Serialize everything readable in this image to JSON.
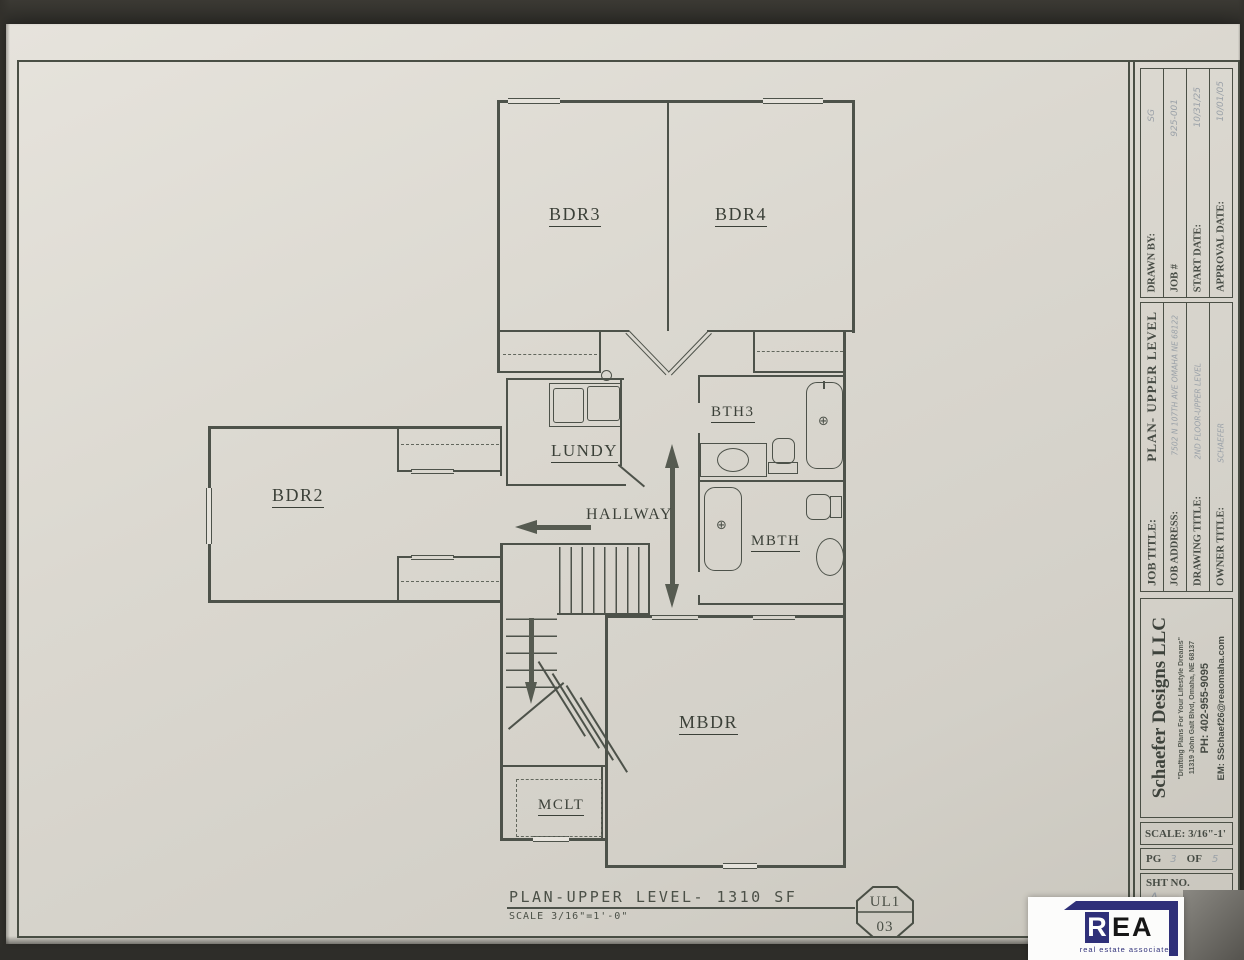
{
  "plan": {
    "rooms": {
      "bdr2": "BDR2",
      "bdr3": "BDR3",
      "bdr4": "BDR4",
      "lundy": "LUNDY",
      "hallway": "HALLWAY",
      "bth3": "BTH3",
      "mbth": "MBTH",
      "mbdr": "MBDR",
      "mclt": "MCLT"
    },
    "footer": {
      "title": "PLAN-UPPER LEVEL- 1310 SF",
      "scale": "SCALE 3/16\"=1'-0\"",
      "tag_top": "UL1",
      "tag_bottom": "03"
    }
  },
  "title_block": {
    "meta": [
      {
        "label": "DRAWN BY:",
        "value": "SG"
      },
      {
        "label": "JOB #",
        "value": "925-001"
      },
      {
        "label": "START DATE:",
        "value": "10/31/25"
      },
      {
        "label": "APPROVAL DATE:",
        "value": "10/01/05"
      }
    ],
    "titles": [
      {
        "label": "JOB TITLE:",
        "value": "PLAN- UPPER LEVEL"
      },
      {
        "label": "JOB ADDRESS:",
        "value": "7502 N 107TH AVE OMAHA NE 68122"
      },
      {
        "label": "DRAWING TITLE:",
        "value": "2ND FLOOR-UPPER LEVEL"
      },
      {
        "label": "OWNER TITLE:",
        "value": "SCHAEFER"
      }
    ],
    "firm": {
      "name": "Schaefer Designs LLC",
      "tagline": "\"Drafting Plans For Your Lifestyle Dreams\"",
      "address": "11319 John Galt Blvd, Omaha, NE 68137",
      "phone": "PH: 402-955-9095",
      "email": "EM: SSchaef26@reaomaha.com"
    },
    "scale": "SCALE: 3/16\"-1'",
    "page": {
      "pg": "PG",
      "pg_no": "3",
      "of": "OF",
      "of_no": "5"
    },
    "sheet": {
      "label": "SHT NO.",
      "rev": "A",
      "no": "1"
    }
  },
  "logo": {
    "r": "R",
    "e": "E",
    "a": "A",
    "subtext": "real estate associates"
  },
  "colors": {
    "accent_navy": "#2f3079",
    "line": "#4d524a",
    "paper": "#dbd8d0"
  }
}
